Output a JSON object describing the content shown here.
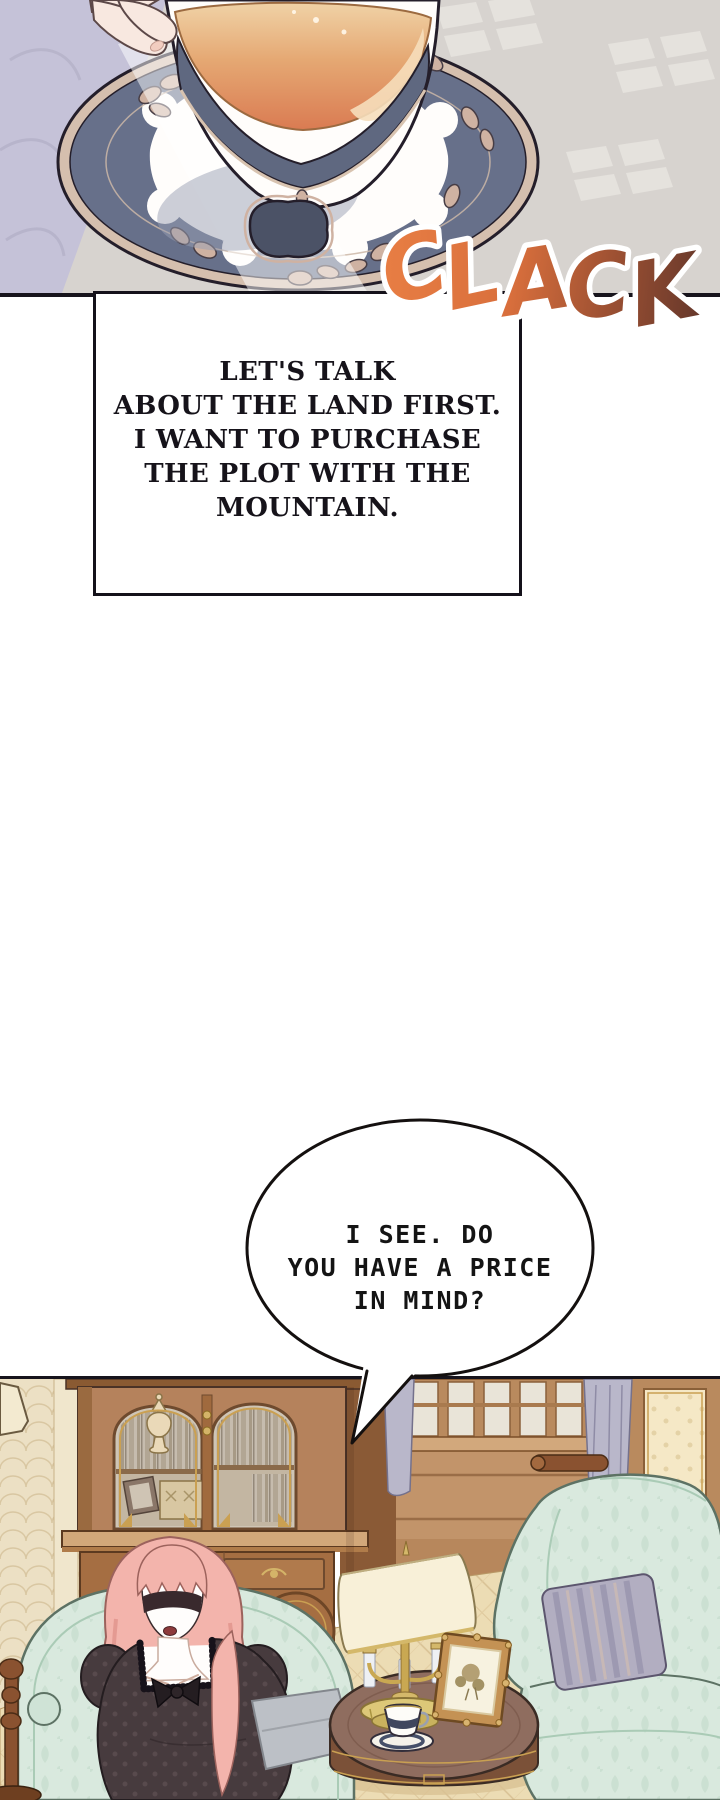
{
  "sfx": {
    "word": "CLACK",
    "letters": [
      "C",
      "L",
      "A",
      "C",
      "K"
    ],
    "color_start": "#ea8045",
    "color_end": "#532f28",
    "outline": "#ffffff"
  },
  "speech_box": {
    "lines": [
      "LET'S TALK",
      "ABOUT THE LAND FIRST.",
      "I WANT TO PURCHASE",
      "THE PLOT WITH THE",
      "MOUNTAIN."
    ],
    "text_color": "#16131a",
    "background": "#ffffff",
    "border_color": "#14111a"
  },
  "speech_bubble": {
    "lines": [
      "I SEE. DO",
      "YOU HAVE A PRICE",
      "IN MIND?"
    ],
    "text_color": "#141414",
    "background": "#ffffff",
    "border_color": "#14100f"
  },
  "palette": {
    "tablecloth_lavender": "#c5c2d8",
    "floor_gray": "#d7d3cf",
    "floor_tile_light": "#e6e3de",
    "saucer_navy": "#67708a",
    "saucer_trim_beige": "#d5bfae",
    "porcelain_white": "#fffdfb",
    "tea_light": "#f0d2a6",
    "tea_deep": "#da7b52",
    "skin": "#f8e8e0",
    "wallpaper_cream": "#ece0c4",
    "wood_brown": "#b5825c",
    "mint_chair": "#d9e9de",
    "parquet": "#ecdcb4",
    "hair_pink": "#f3b4ac",
    "dress_dark": "#473b3e",
    "pillow_gray": "#b2aec1",
    "ink_outline": "#241e2a"
  }
}
